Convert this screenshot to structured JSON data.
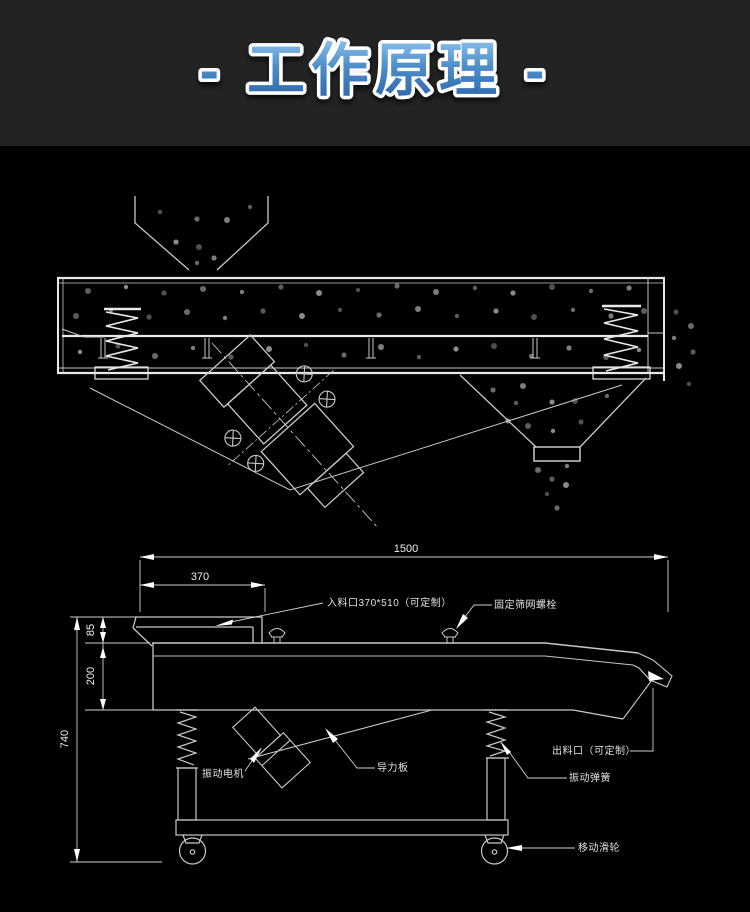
{
  "header": {
    "title": "- 工作原理 -"
  },
  "colors": {
    "header_bg": "#232323",
    "canvas_bg": "#000000",
    "line_gray": "#c9c9c9",
    "title_blue_light": "#8ec3ec",
    "title_blue_mid": "#4c8cc9",
    "title_blue_dark": "#2b62a8",
    "title_stroke": "#ffffff",
    "particle_shades": [
      "#4f4f4f",
      "#6a6a6a",
      "#7d7d7d",
      "#5c5c5c",
      "#8a8a8a"
    ]
  },
  "bottom_diagram": {
    "dimensions": {
      "total_length": "1500",
      "inlet_length": "370",
      "inlet_height": "85",
      "body_height": "200",
      "total_height": "740"
    },
    "labels": {
      "inlet": "入料口370*510（可定制）",
      "mesh_bolt": "固定筛网螺栓",
      "outlet": "出料口（可定制）",
      "motor": "振动电机",
      "guide_plate": "导力板",
      "spring": "振动弹簧",
      "caster": "移动滑轮"
    }
  },
  "top_diagram": {
    "particles": [
      [
        160,
        212
      ],
      [
        197,
        219
      ],
      [
        227,
        220
      ],
      [
        250,
        207
      ],
      [
        176,
        242
      ],
      [
        199,
        247
      ],
      [
        197,
        263
      ],
      [
        214,
        258
      ],
      [
        88,
        291
      ],
      [
        126,
        287
      ],
      [
        164,
        293
      ],
      [
        203,
        289
      ],
      [
        242,
        292
      ],
      [
        281,
        287
      ],
      [
        319,
        293
      ],
      [
        358,
        290
      ],
      [
        397,
        286
      ],
      [
        436,
        292
      ],
      [
        475,
        288
      ],
      [
        513,
        293
      ],
      [
        552,
        287
      ],
      [
        591,
        291
      ],
      [
        629,
        288
      ],
      [
        76,
        316
      ],
      [
        111,
        310
      ],
      [
        149,
        317
      ],
      [
        187,
        312
      ],
      [
        225,
        318
      ],
      [
        263,
        311
      ],
      [
        302,
        316
      ],
      [
        340,
        310
      ],
      [
        379,
        315
      ],
      [
        418,
        309
      ],
      [
        457,
        316
      ],
      [
        496,
        311
      ],
      [
        534,
        317
      ],
      [
        573,
        310
      ],
      [
        611,
        316
      ],
      [
        644,
        311
      ],
      [
        80,
        352
      ],
      [
        118,
        346
      ],
      [
        155,
        356
      ],
      [
        193,
        348
      ],
      [
        231,
        357
      ],
      [
        269,
        349
      ],
      [
        306,
        345
      ],
      [
        344,
        355
      ],
      [
        381,
        347
      ],
      [
        419,
        357
      ],
      [
        456,
        349
      ],
      [
        494,
        346
      ],
      [
        531,
        356
      ],
      [
        569,
        348
      ],
      [
        606,
        357
      ],
      [
        639,
        350
      ],
      [
        676,
        312
      ],
      [
        691,
        326
      ],
      [
        674,
        338
      ],
      [
        693,
        352
      ],
      [
        679,
        366
      ],
      [
        689,
        384
      ],
      [
        493,
        390
      ],
      [
        523,
        386
      ],
      [
        516,
        403
      ],
      [
        552,
        402
      ],
      [
        575,
        401
      ],
      [
        607,
        396
      ],
      [
        508,
        421
      ],
      [
        528,
        426
      ],
      [
        553,
        431
      ],
      [
        581,
        422
      ],
      [
        538,
        470
      ],
      [
        567,
        466
      ],
      [
        552,
        479
      ],
      [
        566,
        485
      ],
      [
        547,
        494
      ],
      [
        557,
        508
      ]
    ]
  }
}
